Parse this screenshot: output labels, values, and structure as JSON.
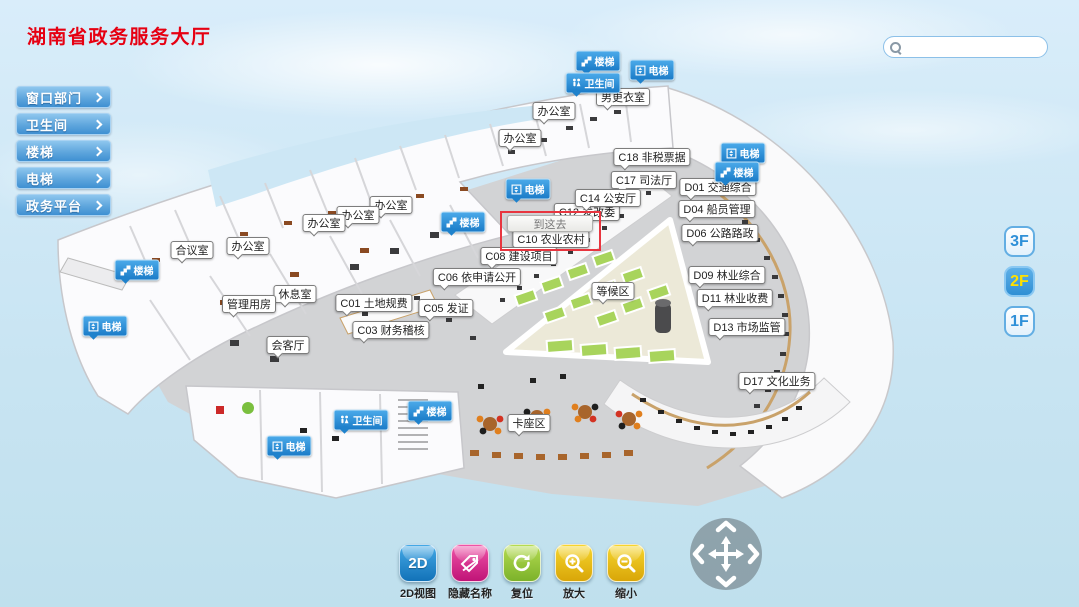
{
  "title": "湖南省政务服务大厅",
  "search": {
    "placeholder": ""
  },
  "sidebar": {
    "items": [
      {
        "key": "window-departments",
        "label": "窗口部门"
      },
      {
        "key": "restroom",
        "label": "卫生间"
      },
      {
        "key": "stairs",
        "label": "楼梯"
      },
      {
        "key": "elevator",
        "label": "电梯"
      },
      {
        "key": "gov-platform",
        "label": "政务平台"
      }
    ]
  },
  "floor_switcher": {
    "items": [
      {
        "key": "3f",
        "label": "3F",
        "active": false
      },
      {
        "key": "2f",
        "label": "2F",
        "active": true
      },
      {
        "key": "1f",
        "label": "1F",
        "active": false
      }
    ]
  },
  "toolbar": {
    "items": [
      {
        "key": "2d-view",
        "label": "2D视图",
        "icon": "2d-view-icon",
        "color_top": "#45a9e6",
        "color_bottom": "#1272b8"
      },
      {
        "key": "hide-names",
        "label": "隐藏名称",
        "icon": "hide-names-icon",
        "color_top": "#ef55a8",
        "color_bottom": "#c01377"
      },
      {
        "key": "reset",
        "label": "复位",
        "icon": "reset-icon",
        "color_top": "#b5dc52",
        "color_bottom": "#7cb22a"
      },
      {
        "key": "zoom-in",
        "label": "放大",
        "icon": "zoom-in-icon",
        "color_top": "#f6d62e",
        "color_bottom": "#d9a608"
      },
      {
        "key": "zoom-out",
        "label": "缩小",
        "icon": "zoom-out-icon",
        "color_top": "#f6d62e",
        "color_bottom": "#d9a608"
      }
    ]
  },
  "map": {
    "popup": {
      "text": "到这去"
    },
    "labels": [
      {
        "type": "stairs",
        "text": "楼梯",
        "x": 598,
        "y": 61
      },
      {
        "type": "elevator",
        "text": "电梯",
        "x": 652,
        "y": 70
      },
      {
        "type": "toilet",
        "text": "卫生间",
        "x": 593,
        "y": 83
      },
      {
        "type": "elevator",
        "text": "电梯",
        "x": 743,
        "y": 153
      },
      {
        "type": "stairs",
        "text": "楼梯",
        "x": 737,
        "y": 172
      },
      {
        "type": "elevator",
        "text": "电梯",
        "x": 528,
        "y": 189
      },
      {
        "type": "stairs",
        "text": "楼梯",
        "x": 463,
        "y": 222
      },
      {
        "type": "stairs",
        "text": "楼梯",
        "x": 137,
        "y": 270
      },
      {
        "type": "elevator",
        "text": "电梯",
        "x": 105,
        "y": 326
      },
      {
        "type": "stairs",
        "text": "楼梯",
        "x": 430,
        "y": 411
      },
      {
        "type": "toilet",
        "text": "卫生间",
        "x": 361,
        "y": 420
      },
      {
        "type": "elevator",
        "text": "电梯",
        "x": 289,
        "y": 446
      },
      {
        "type": "room",
        "text": "男更衣室",
        "x": 623,
        "y": 97
      },
      {
        "type": "room",
        "text": "办公室",
        "x": 554,
        "y": 111
      },
      {
        "type": "room",
        "text": "办公室",
        "x": 520,
        "y": 138
      },
      {
        "type": "room",
        "text": "C18 非税票据",
        "x": 652,
        "y": 157
      },
      {
        "type": "room",
        "text": "C17 司法厅",
        "x": 644,
        "y": 180
      },
      {
        "type": "room",
        "text": "C14 公安厅",
        "x": 608,
        "y": 198
      },
      {
        "type": "room",
        "text": "C12 发改委",
        "x": 587,
        "y": 212,
        "behind": true
      },
      {
        "type": "room",
        "text": "C10 农业农村",
        "x": 551,
        "y": 239
      },
      {
        "type": "room",
        "text": "C08 建设项目",
        "x": 519,
        "y": 256
      },
      {
        "type": "room",
        "text": "C06 依申请公开",
        "x": 477,
        "y": 277
      },
      {
        "type": "room",
        "text": "等候区",
        "x": 613,
        "y": 291
      },
      {
        "type": "room",
        "text": "C01 土地规费",
        "x": 374,
        "y": 303
      },
      {
        "type": "room",
        "text": "C05 发证",
        "x": 446,
        "y": 308
      },
      {
        "type": "room",
        "text": "C03 财务稽核",
        "x": 391,
        "y": 330
      },
      {
        "type": "room",
        "text": "办公室",
        "x": 391,
        "y": 205
      },
      {
        "type": "room",
        "text": "办公室",
        "x": 358,
        "y": 215
      },
      {
        "type": "room",
        "text": "办公室",
        "x": 324,
        "y": 223
      },
      {
        "type": "room",
        "text": "办公室",
        "x": 248,
        "y": 246
      },
      {
        "type": "room",
        "text": "合议室",
        "x": 192,
        "y": 250
      },
      {
        "type": "room",
        "text": "休息室",
        "x": 295,
        "y": 294
      },
      {
        "type": "room",
        "text": "管理用房",
        "x": 249,
        "y": 304
      },
      {
        "type": "room",
        "text": "会客厅",
        "x": 288,
        "y": 345
      },
      {
        "type": "room",
        "text": "卡座区",
        "x": 529,
        "y": 423
      },
      {
        "type": "room",
        "text": "D01 交通综合",
        "x": 718,
        "y": 187
      },
      {
        "type": "room",
        "text": "D04 船员管理",
        "x": 717,
        "y": 209
      },
      {
        "type": "room",
        "text": "D06 公路路政",
        "x": 720,
        "y": 233
      },
      {
        "type": "room",
        "text": "D09 林业综合",
        "x": 727,
        "y": 275
      },
      {
        "type": "room",
        "text": "D11 林业收费",
        "x": 735,
        "y": 298
      },
      {
        "type": "room",
        "text": "D13 市场监管",
        "x": 747,
        "y": 327
      },
      {
        "type": "room",
        "text": "D17 文化业务",
        "x": 777,
        "y": 381
      }
    ]
  }
}
